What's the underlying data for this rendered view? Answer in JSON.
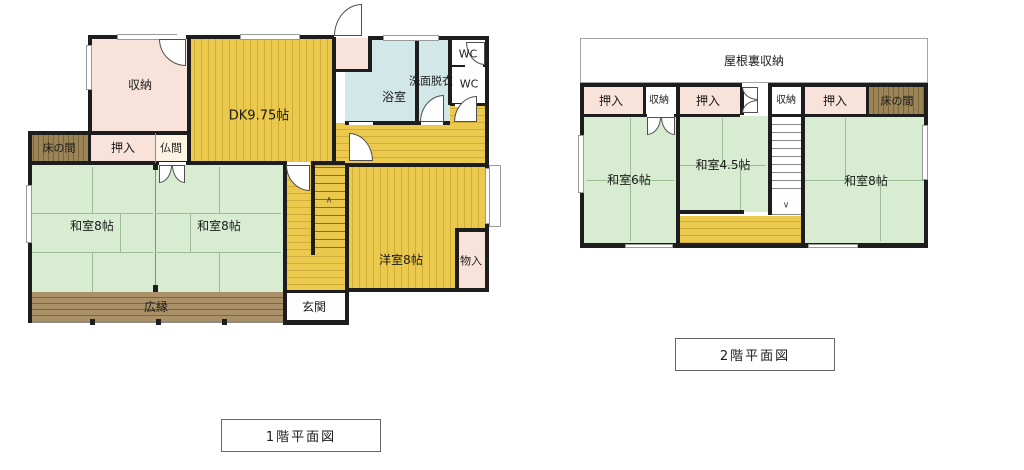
{
  "floor1": {
    "caption": "1階平面図",
    "labels": {
      "shunou": "収納",
      "dk": "DK9.75帖",
      "yokushitsu": "浴室",
      "senmen_datsui": "洗面脱衣",
      "wc_upper": "WC",
      "wc_lower": "WC",
      "tokonoma": "床の間",
      "oshiire": "押入",
      "butsuma": "仏間",
      "washitsu_left": "和室8帖",
      "washitsu_right": "和室8帖",
      "youshitsu": "洋室8帖",
      "monoire": "物入",
      "hiroen": "広縁",
      "genkan": "玄関",
      "stair_up_mark": "∧"
    }
  },
  "floor2": {
    "caption": "2階平面図",
    "labels": {
      "yaneura_shunou": "屋根裏収納",
      "oshiire_left": "押入",
      "shunou_left": "収納",
      "oshiire_center": "押入",
      "shunou_right": "収納",
      "oshiire_right": "押入",
      "tokonoma": "床の間",
      "washitsu_6": "和室6帖",
      "washitsu_45": "和室4.5帖",
      "washitsu_8": "和室8帖",
      "stair_down_mark": "∨"
    }
  },
  "legend_colors": {
    "wall": "#1d1d1d",
    "wood_flooring_yellow": "#eac94d",
    "tatami_green": "#d7ecd1",
    "closet_pink": "#f8e2d9",
    "bath_blue": "#d2e7e7",
    "veranda_brown": "#ab9168",
    "tokonoma_brown": "#9b8557"
  }
}
